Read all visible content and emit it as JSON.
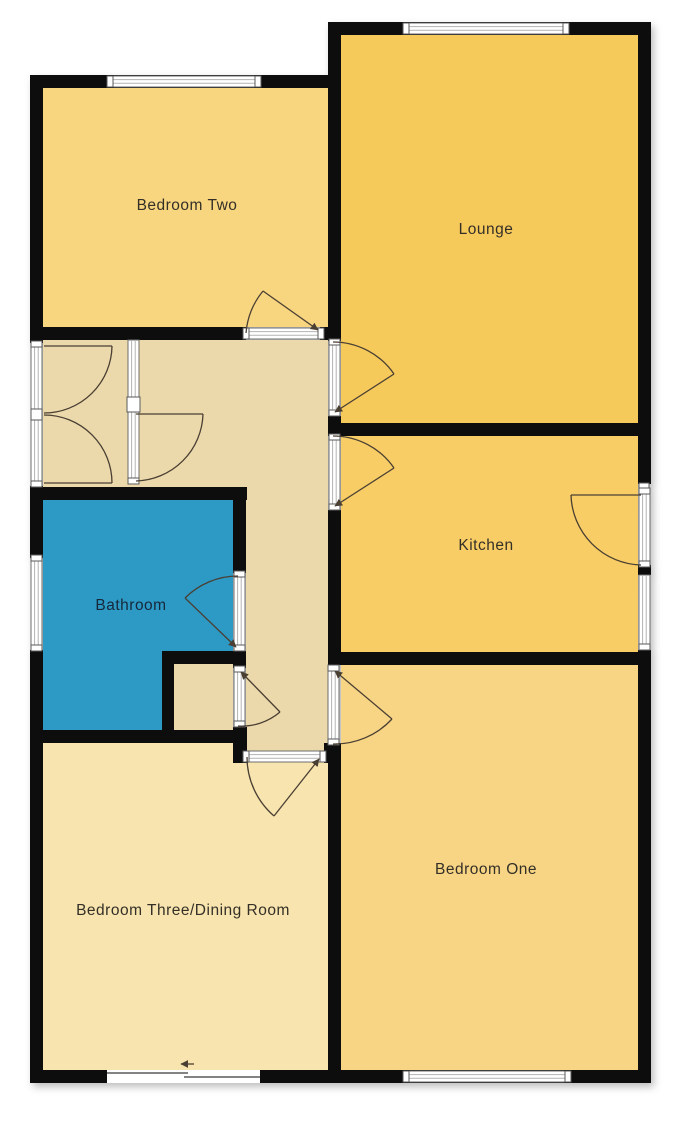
{
  "plan_title": "Bungalow floor plan",
  "colors": {
    "background": "#ffffff",
    "wall": "#0d0d0d",
    "hall": "#ecd9ab",
    "label_text": "#343028",
    "bathroom_label_text": "#16283a",
    "door_swing": "#4a3f33",
    "window_fill": "#ffffff",
    "window_frame": "#6e6e6e"
  },
  "rooms": {
    "bedroom_two": {
      "label": "Bedroom Two",
      "color": "#f8d57f"
    },
    "lounge": {
      "label": "Lounge",
      "color": "#f6c95b"
    },
    "kitchen": {
      "label": "Kitchen",
      "color": "#f8cd65"
    },
    "bathroom": {
      "label": "Bathroom",
      "color": "#2d9ac6"
    },
    "bedroom_one": {
      "label": "Bedroom One",
      "color": "#f8d584"
    },
    "bedroom_three": {
      "label": "Bedroom Three/Dining Room",
      "color": "#f8e4ae"
    },
    "hallway": {
      "label": "",
      "color": "#ecd9ab"
    }
  }
}
